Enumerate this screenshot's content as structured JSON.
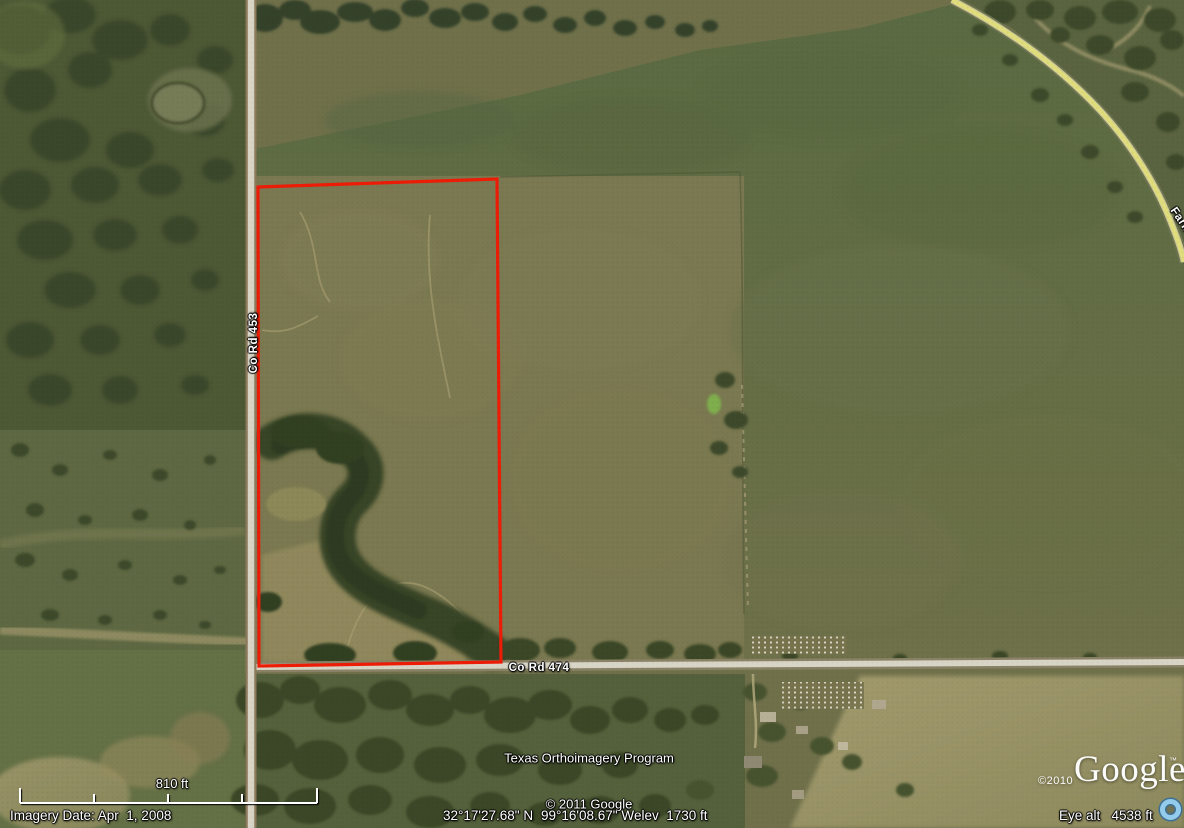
{
  "colors": {
    "boundary-red": "#ed1c07",
    "road-yellow": "#e0dd7d",
    "road-white": "#d9d5c6",
    "label-white": "#ffffff",
    "streaming-blue": "#93cbec"
  },
  "map": {
    "road_labels": {
      "vertical": "Co Rd 453",
      "horizontal": "Co Rd 474",
      "partial": "Farm"
    },
    "attribution": {
      "program": "Texas Orthoimagery Program",
      "copyright": "© 2011 Google"
    },
    "watermark": {
      "year": "©2010",
      "brand": "Google",
      "tm": "™"
    }
  },
  "scale_bar": {
    "label": "810 ft"
  },
  "status_bar": {
    "imagery_date": "Imagery Date: Apr  1, 2008",
    "latitude": "32°17'27.68\" N",
    "longitude": "99°16'08.67\" W",
    "elevation": "elev  1730 ft",
    "eye_altitude": "Eye alt   4538 ft"
  }
}
